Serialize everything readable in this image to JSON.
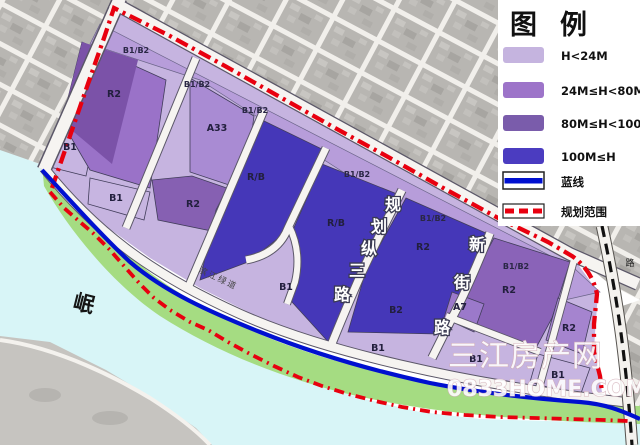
{
  "legend": {
    "title": {
      "char1": "图",
      "char2": "例"
    },
    "items": [
      {
        "label": "H<24M",
        "color": "#c5b4df"
      },
      {
        "label": "24M≤H<80M",
        "color": "#9d74c9"
      },
      {
        "label": "80M≤H<100M",
        "color": "#7a5cab"
      },
      {
        "label": "100M≤H",
        "color": "#4b3cc0"
      },
      {
        "label": "蓝线",
        "color": "#0010d0"
      },
      {
        "label": "规划范围",
        "color": "#e8000f"
      }
    ]
  },
  "map": {
    "parcel_labels": [
      {
        "t": "B1"
      },
      {
        "t": "R2"
      },
      {
        "t": "B1"
      },
      {
        "t": "A33"
      },
      {
        "t": "R2"
      },
      {
        "t": "R/B"
      },
      {
        "t": "R/B"
      },
      {
        "t": "B1"
      },
      {
        "t": "R2"
      },
      {
        "t": "B2"
      },
      {
        "t": "B1"
      },
      {
        "t": "R2"
      },
      {
        "t": "A7"
      },
      {
        "t": "B1"
      },
      {
        "t": "R2"
      },
      {
        "t": "B1"
      }
    ],
    "strip_labels": [
      {
        "t": "B1/B2"
      },
      {
        "t": "B1/B2"
      },
      {
        "t": "B1/B2"
      },
      {
        "t": "B1/B2"
      },
      {
        "t": "B1/B2"
      },
      {
        "t": "B1/B2"
      }
    ],
    "road_labels": {
      "v1": {
        "name": "规划纵三路",
        "chars": [
          "规",
          "划",
          "纵",
          "三",
          "路"
        ]
      },
      "v2": {
        "name": "新街路",
        "chars": [
          "新",
          "街",
          "路"
        ]
      },
      "riverside": "滨江绿道",
      "right_road": "路"
    },
    "river_label": "岷",
    "zone_colors": {
      "h24": "#c6b4e0",
      "h24_80": "#9d74c9",
      "h80_100": "#7a5cab",
      "h100": "#4537b8",
      "strip": "#b79dda",
      "green": "#a5dc82",
      "water": "#d8f5f7",
      "blue_line": "#0010d0",
      "boundary_red": "#e8000f"
    }
  },
  "watermark": {
    "site_name": "三江房产网",
    "site_url": "0833HOME.COM"
  }
}
